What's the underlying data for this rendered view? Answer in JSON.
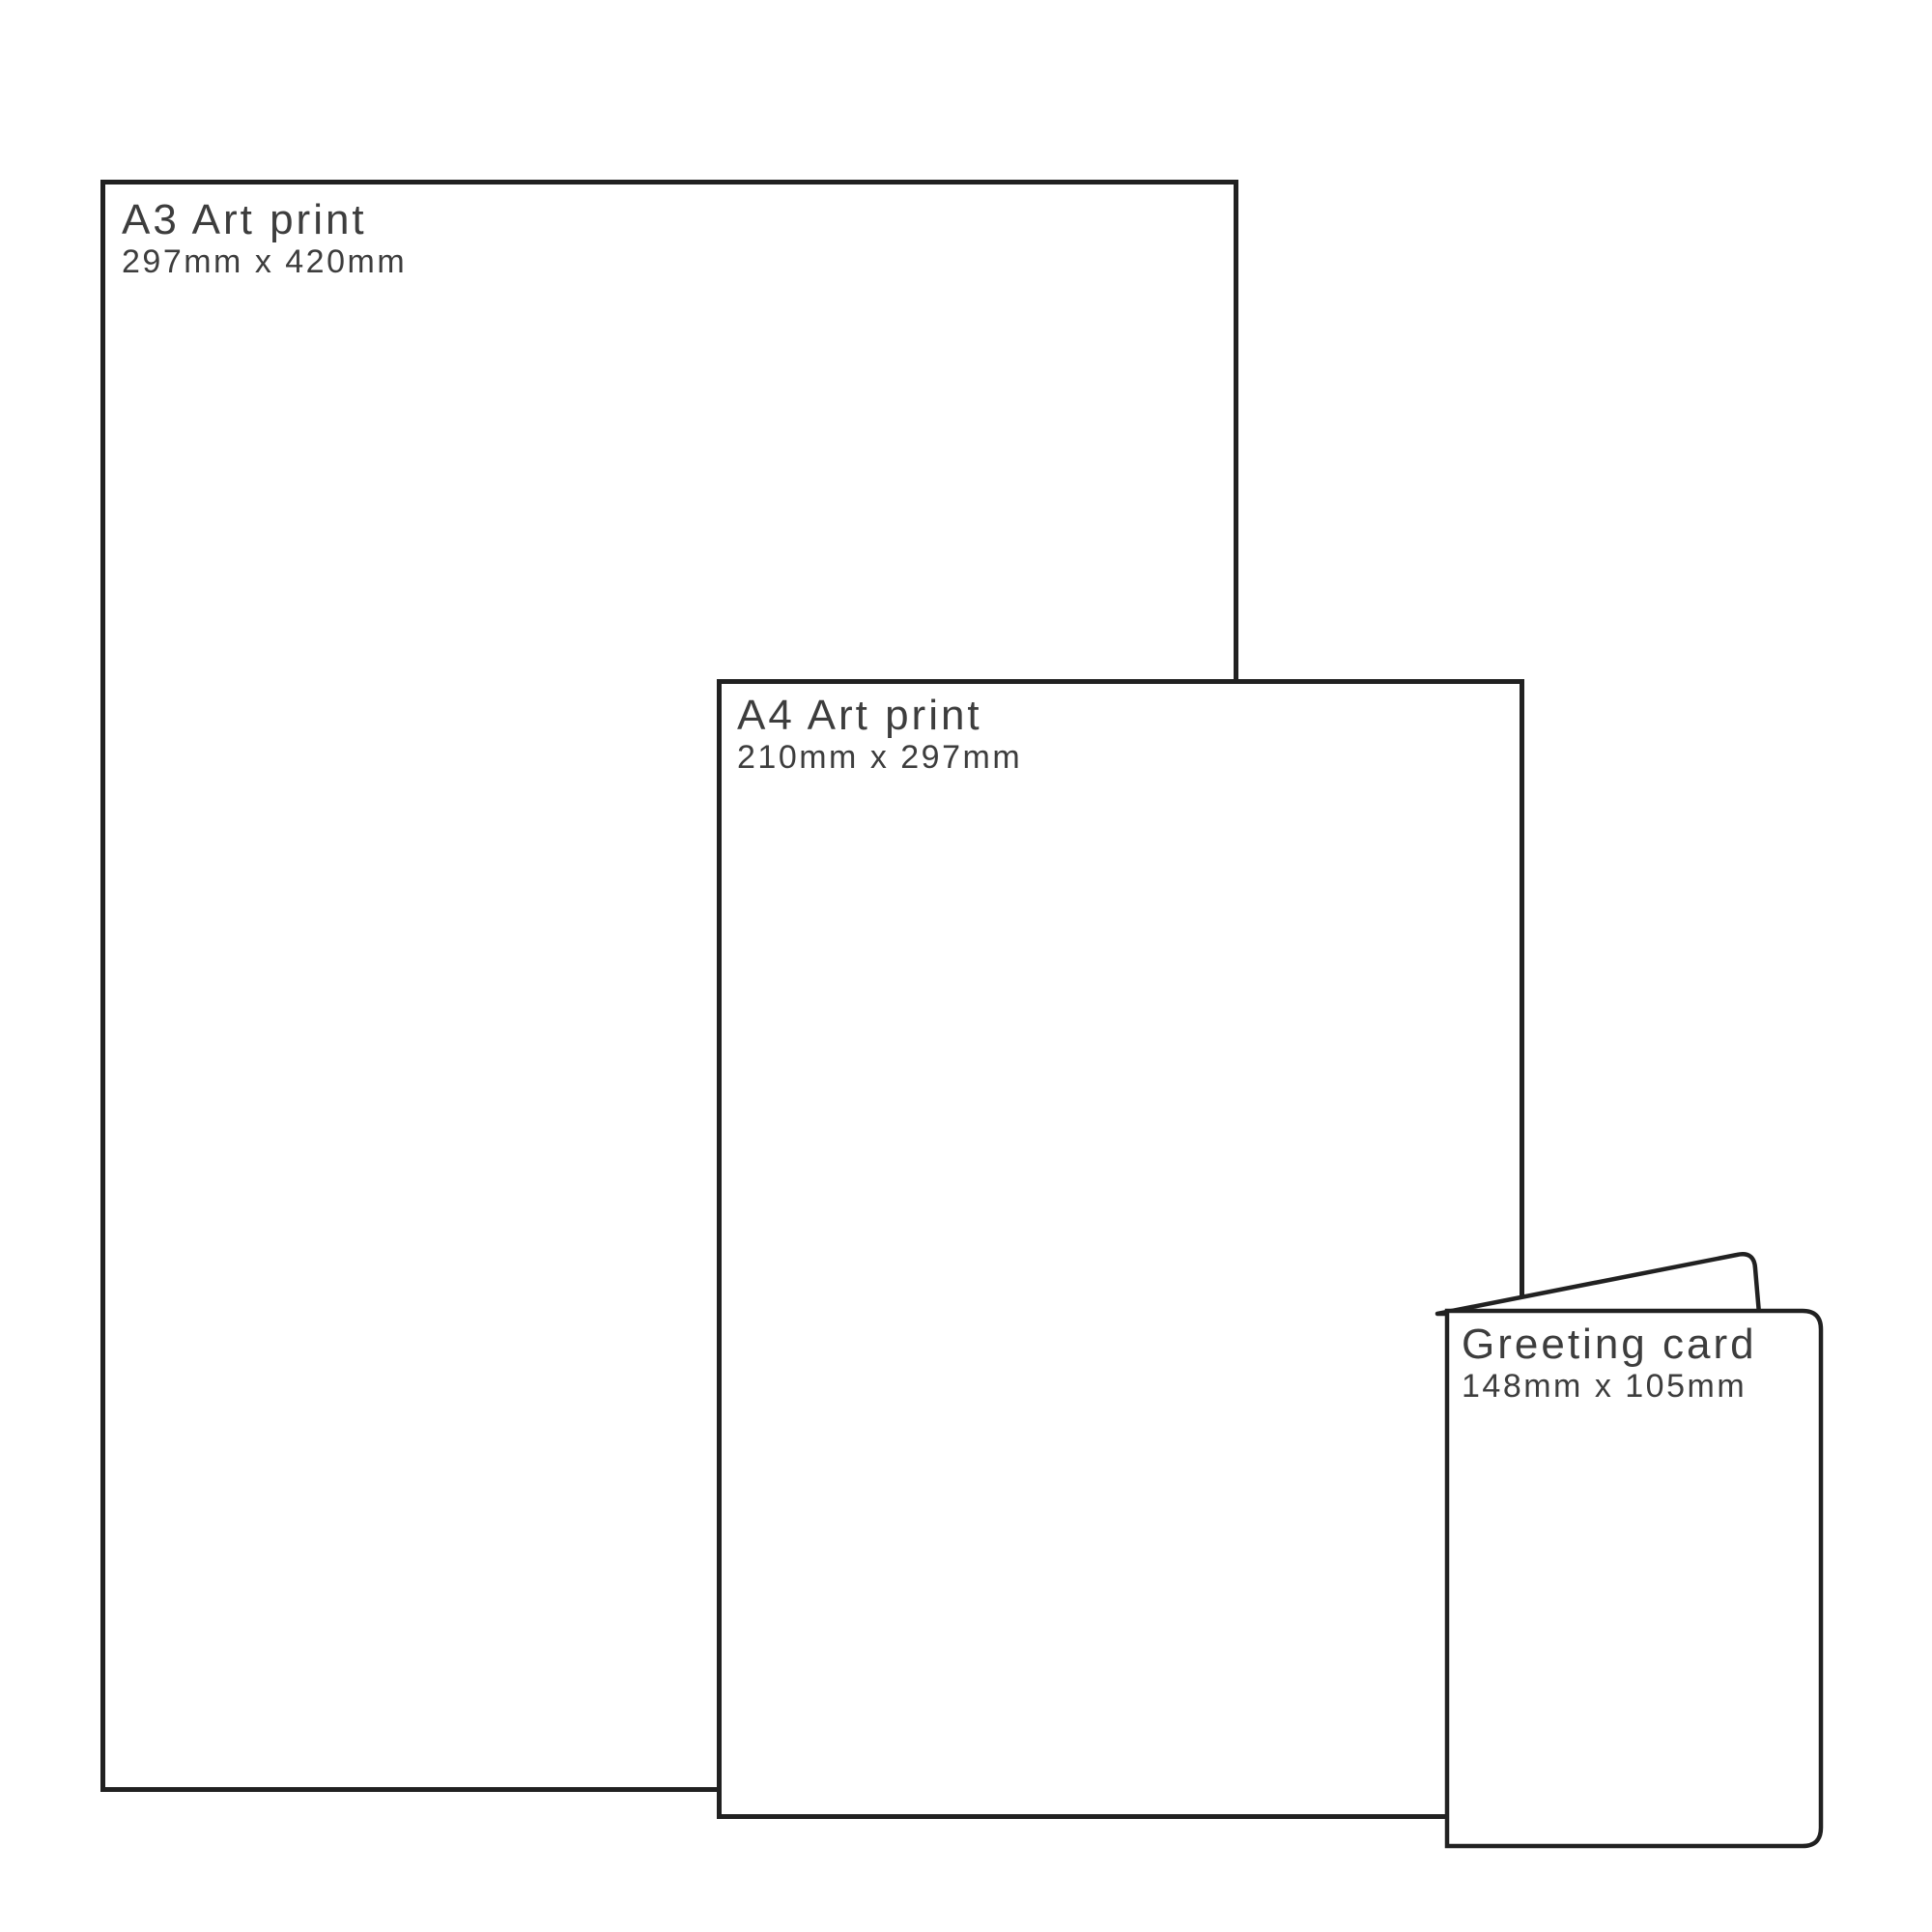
{
  "page": {
    "background_color": "#ffffff",
    "line_color": "#212121",
    "text_color": "#3d3d3d"
  },
  "items": [
    {
      "id": "a3-art-print",
      "name": "A3 Art print",
      "size": "297mm x 420mm"
    },
    {
      "id": "a4-art-print",
      "name": "A4 Art print",
      "size": "210mm x 297mm"
    },
    {
      "id": "greeting-card",
      "name": "Greeting card",
      "size": "148mm x 105mm"
    }
  ]
}
